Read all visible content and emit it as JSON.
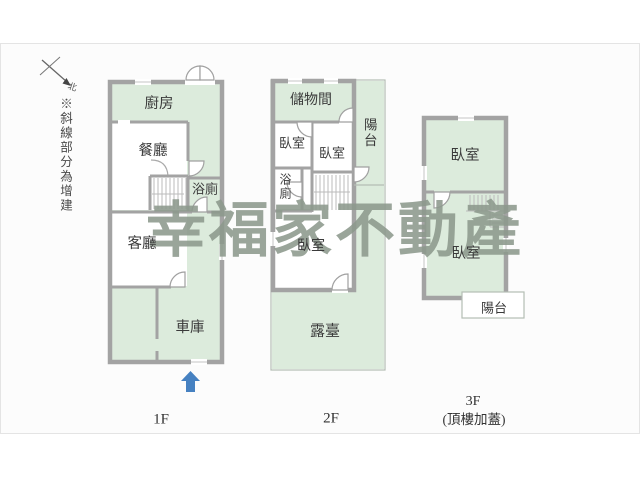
{
  "canvas": {
    "background": "#fcfcfc",
    "border": "#e4e4e4"
  },
  "colors": {
    "room_fill": "#dcebdc",
    "wall": "#a3a3a3",
    "thin_line": "#b4bdb4",
    "watermark": "#8c988c",
    "label_text": "#3a3a3a",
    "entrance_arrow": "#4681c1"
  },
  "compass": {
    "icon": "north-arrow-icon",
    "north_label": "北"
  },
  "annotation": {
    "note": "※斜線部分為增建"
  },
  "watermark": {
    "text": "幸福家不動產"
  },
  "floors": {
    "f1": {
      "caption": "1F",
      "rooms": {
        "kitchen": "廚房",
        "dining": "餐廳",
        "bathroom": "浴廁",
        "living": "客廳",
        "garage": "車庫"
      }
    },
    "f2": {
      "caption": "2F",
      "rooms": {
        "storage": "儲物間",
        "bedroom_left": "臥室",
        "bedroom_center": "臥室",
        "bathroom": "浴廁",
        "balcony": "陽台",
        "bedroom_south": "臥室",
        "terrace": "露臺"
      }
    },
    "f3": {
      "caption": "3F",
      "caption_note": "(頂樓加蓋)",
      "rooms": {
        "bedroom_north": "臥室",
        "bedroom_south": "臥室",
        "balcony": "陽台"
      }
    }
  }
}
